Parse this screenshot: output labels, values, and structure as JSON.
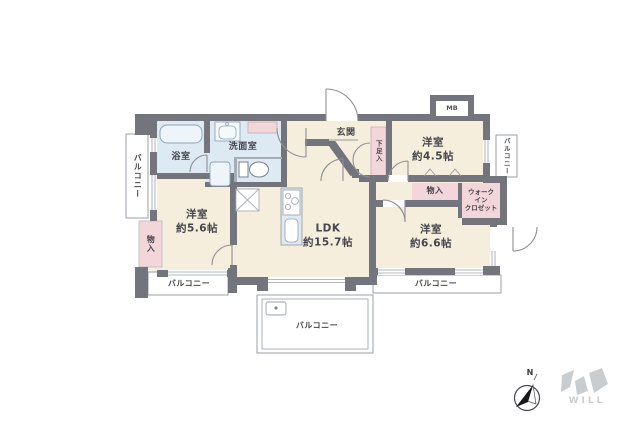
{
  "page": {
    "background": "#ffffff"
  },
  "colors": {
    "wall": "#74747c",
    "floor": "#f6eedd",
    "sanitary_blue": "#dde9f3",
    "closet_pink": "#f3d6d9",
    "balcony_white": "#ffffff",
    "line_gray": "#8e8e96",
    "text": "#45454b",
    "logo_gray": "#c9cdd0"
  },
  "rooms": {
    "ldk": {
      "label": "LDK\n約15.7帖"
    },
    "bedroom_west": {
      "label": "洋室\n約5.6帖"
    },
    "bedroom_northeast": {
      "label": "洋室\n約4.5帖"
    },
    "bedroom_southeast": {
      "label": "洋室\n約6.6帖"
    },
    "bath": {
      "label": "浴室"
    },
    "washroom": {
      "label": "洗面室"
    },
    "entrance": {
      "label": "玄関"
    },
    "walk_in_closet": {
      "label": "ウォーク\nイン\nクロゼット"
    },
    "storage_west": {
      "label": "物入"
    },
    "storage_center": {
      "label": "物入"
    },
    "shoe_cabinet": {
      "label": "下足入"
    },
    "meter_box": {
      "label": "MB"
    }
  },
  "balconies": {
    "west": {
      "label": "バルコニー"
    },
    "east": {
      "label": "バルコニー"
    },
    "south_left": {
      "label": "バルコニー"
    },
    "south_center": {
      "label": "バルコニー"
    },
    "south_right": {
      "label": "バルコニー"
    }
  },
  "compass": {
    "north_label": "N"
  },
  "logo": {
    "text": "WILL"
  }
}
